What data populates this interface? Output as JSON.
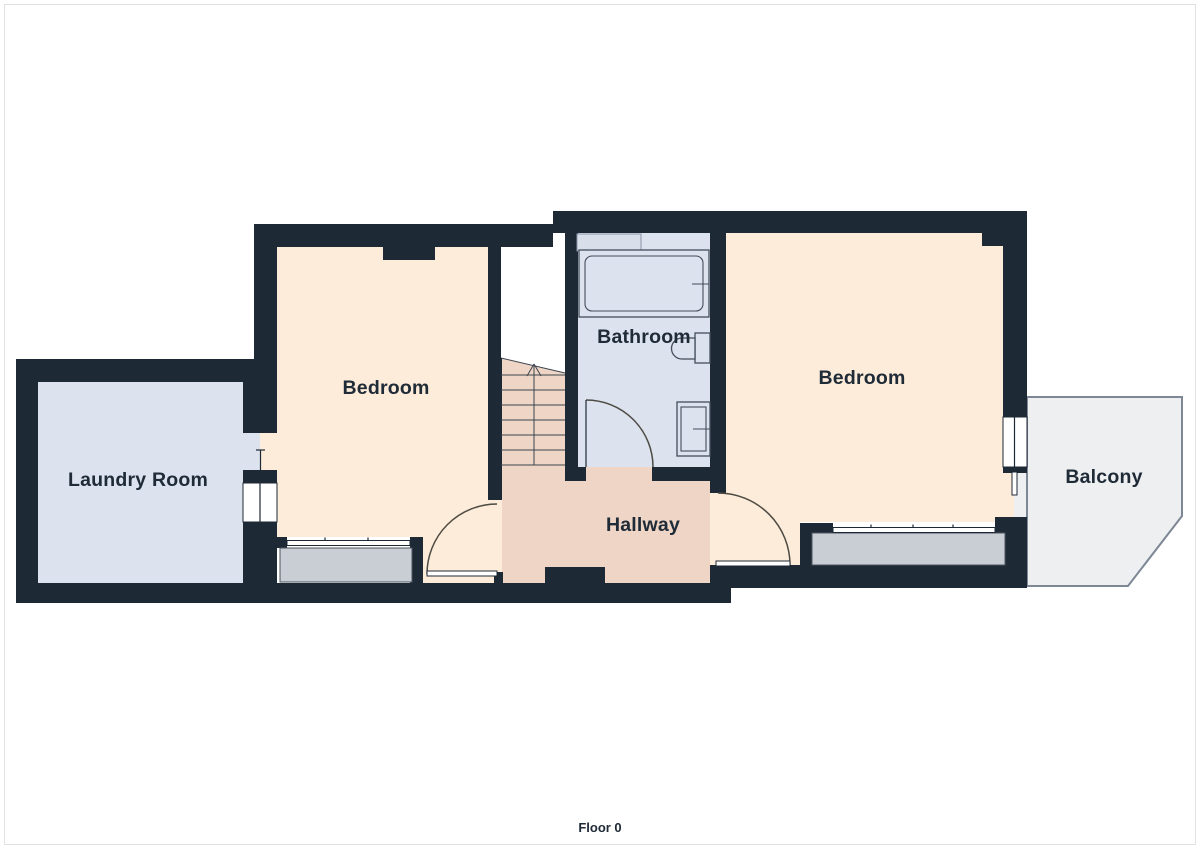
{
  "title": "Floor plan",
  "floor_label": "Floor 0",
  "rooms": [
    {
      "id": "laundry-room",
      "label": "Laundry Room"
    },
    {
      "id": "bedroom-left",
      "label": "Bedroom"
    },
    {
      "id": "bathroom",
      "label": "Bathroom"
    },
    {
      "id": "hallway",
      "label": "Hallway"
    },
    {
      "id": "bedroom-right",
      "label": "Bedroom"
    },
    {
      "id": "balcony",
      "label": "Balcony"
    }
  ],
  "fixtures": [
    "bathtub",
    "toilet",
    "sink",
    "staircase-up",
    "window-left-bedroom",
    "window-right-bedroom",
    "laundry-door",
    "balcony-door",
    "bedroom-doors",
    "bathroom-door"
  ],
  "colors": {
    "wall": "#1e2936",
    "bedroom_floor": "#fdecd9",
    "wet_room_floor": "#dce2ee",
    "hallway_floor": "#eed5c5",
    "window_sill": "#c9ced4",
    "balcony_floor": "#edeff1",
    "door_swing": "#4d4b43",
    "label_text": "#202b38",
    "page_border": "#e2e2e2"
  }
}
